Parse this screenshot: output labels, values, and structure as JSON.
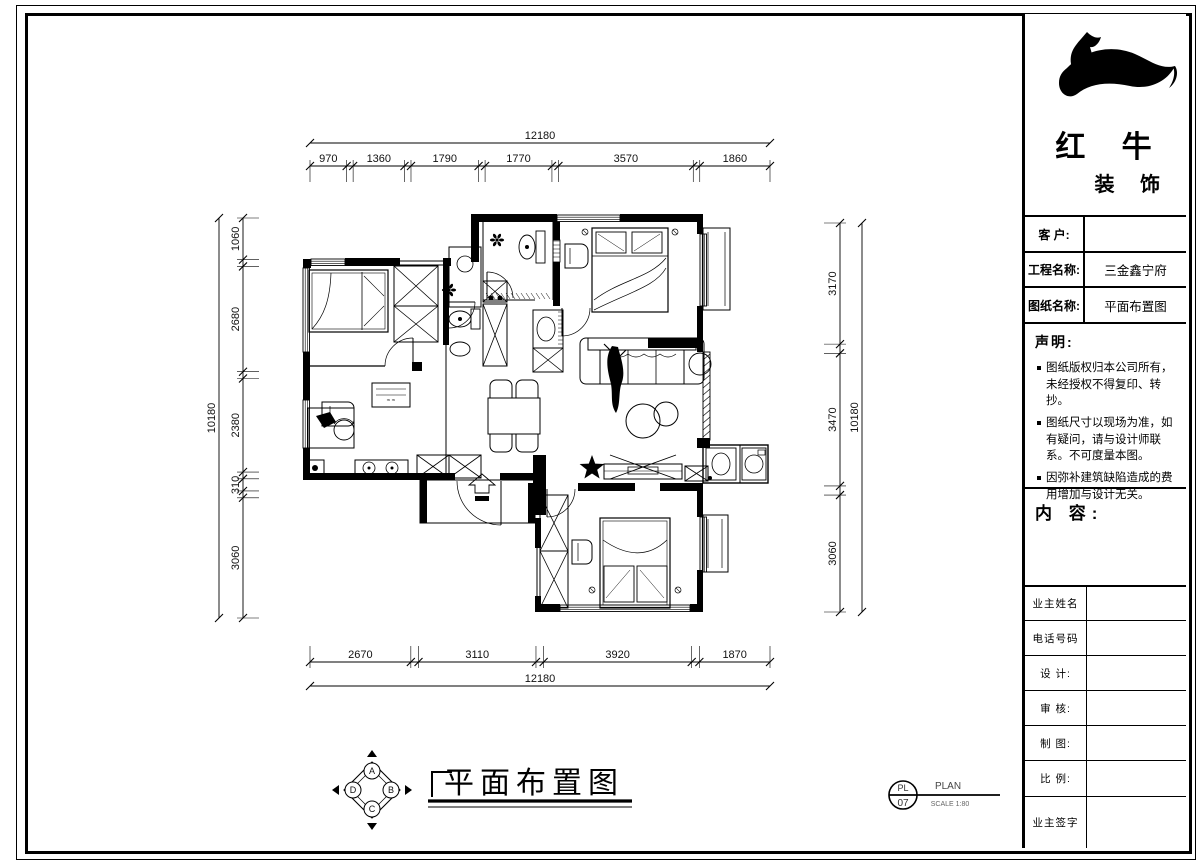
{
  "sheet": {
    "bg": "#ffffff",
    "line_color": "#000000"
  },
  "title_block": {
    "logo": {
      "line1": "红 牛",
      "line2": "装 饰",
      "mark": "bull-swoosh"
    },
    "info_rows": [
      {
        "label": "客  户:",
        "value": ""
      },
      {
        "label": "工程名称:",
        "value": "三金鑫宁府"
      },
      {
        "label": "图纸名称:",
        "value": "平面布置图"
      }
    ],
    "statement": {
      "heading": "声明:",
      "items": [
        "图纸版权归本公司所有，未经授权不得复印、转抄。",
        "图纸尺寸以现场为准，如有疑问，请与设计师联系。不可度量本图。",
        "因弥补建筑缺陷造成的费用增加与设计无关。"
      ]
    },
    "content_heading": "内 容:",
    "sign_rows": [
      "业主姓名",
      "电话号码",
      "设 计:",
      "审 核:",
      "制 图:",
      "比 例:",
      "业主签字"
    ]
  },
  "plan": {
    "dims": {
      "top": {
        "total": "12180",
        "segments": [
          "970",
          "1360",
          "1790",
          "1770",
          "3570",
          "1860"
        ]
      },
      "bottom": {
        "total": "12180",
        "segments": [
          "2670",
          "3110",
          "3920",
          "1870"
        ]
      },
      "left": {
        "total": "10180",
        "segments": [
          "1060",
          "2680",
          "2380",
          "310",
          "3060"
        ]
      },
      "right": {
        "total": "10180",
        "segments": [
          "3170",
          "3470",
          "3060"
        ]
      }
    }
  },
  "footer": {
    "title": "平面布置图",
    "compass_letters": [
      "A",
      "B",
      "C",
      "D"
    ],
    "stamp": {
      "top": "PL",
      "bottom": "07",
      "label": "PLAN",
      "scale": "SCALE 1:80"
    }
  }
}
